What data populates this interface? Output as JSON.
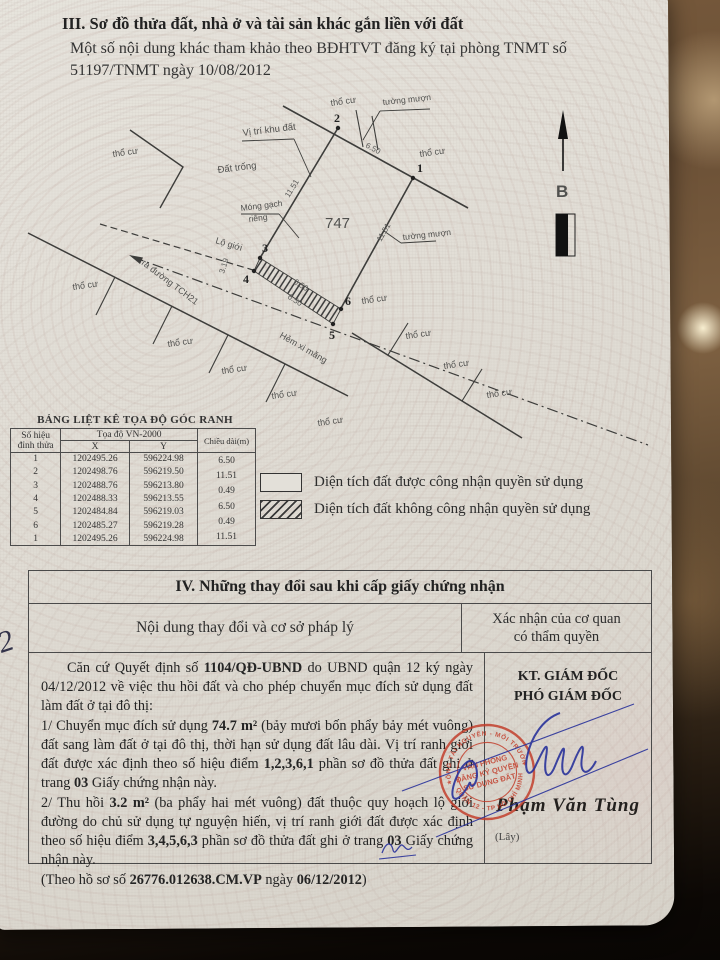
{
  "header": {
    "section3_title": "III. Sơ đồ thửa đất, nhà ở và tài sản khác gắn liền với đất",
    "note_line1": "Một số nội dung khác tham khảo theo BĐHTVT đăng ký tại phòng TNMT số",
    "note_line2": "51197/TNMT ngày 10/08/2012"
  },
  "map": {
    "parcel_number": "747",
    "north_label": "B",
    "labels": {
      "tho_cu": "thổ cư",
      "tuong_muon": "tường mượn",
      "vi_tri_khu_dat": "Vị trí khu đất",
      "dat_trong": "Đất trống",
      "mong_gach_1": "Móng gạch",
      "mong_gach_2": "riêng",
      "lo_gioi": "Lộ giới",
      "ra_duong": "ra đường TCH21",
      "hem_xi_mang": "Hẻm xi măng"
    },
    "points": {
      "p1": "1",
      "p2": "2",
      "p3": "3",
      "p4": "4",
      "p5": "5",
      "p6": "6"
    },
    "dims": {
      "d650": "6.50",
      "d1151": "11.51",
      "d319": "3.19"
    }
  },
  "coord_table": {
    "title": "BẢNG LIỆT KÊ TỌA ĐỘ GÓC RANH",
    "header": {
      "point": "Số hiệu",
      "point2": "đỉnh thửa",
      "coords": "Tọa độ VN-2000",
      "x": "X",
      "y": "Y",
      "length": "Chiều dài(m)"
    },
    "rows": [
      [
        "1",
        "1202495.26",
        "596224.98"
      ],
      [
        "2",
        "1202498.76",
        "596219.50"
      ],
      [
        "3",
        "1202488.76",
        "596213.80"
      ],
      [
        "4",
        "1202488.33",
        "596213.55"
      ],
      [
        "5",
        "1202484.84",
        "596219.03"
      ],
      [
        "6",
        "1202485.27",
        "596219.28"
      ],
      [
        "1",
        "1202495.26",
        "596224.98"
      ]
    ],
    "lengths": [
      "6.50",
      "11.51",
      "0.49",
      "6.50",
      "0.49",
      "11.51"
    ]
  },
  "legend": {
    "items": [
      {
        "style": "plain",
        "label": "Diện tích đất được công nhận quyền sử dụng"
      },
      {
        "style": "hatched",
        "label": "Diện tích đất không công nhận quyền sử dụng"
      }
    ]
  },
  "section4": {
    "title": "IV. Những thay đổi sau khi cấp giấy chứng nhận",
    "col_left": "Nội dung thay đổi và cơ sở pháp lý",
    "col_right_1": "Xác nhận của cơ quan",
    "col_right_2": "có thẩm quyền",
    "paragraphs": [
      [
        {
          "t": "Căn cứ Quyết định số "
        },
        {
          "t": "1104/QĐ-UBND",
          "b": true
        },
        {
          "t": " do UBND quận 12 ký ngày 04/12/2012 về việc thu hồi đất và cho phép chuyển mục đích sử dụng đất làm đất ở tại đô thị:"
        }
      ],
      [
        {
          "t": "1/ Chuyển mục đích sử dụng "
        },
        {
          "t": "74.7 m²",
          "b": true
        },
        {
          "t": " (bảy mươi bốn phẩy bảy mét vuông) đất sang làm đất ở tại đô thị, thời hạn sử dụng đất lâu dài. Vị trí ranh giới đất được xác định theo số hiệu điểm "
        },
        {
          "t": "1,2,3,6,1",
          "b": true
        },
        {
          "t": " phần sơ đồ thửa đất ghi ở trang "
        },
        {
          "t": "03",
          "b": true
        },
        {
          "t": " Giấy chứng nhận này."
        }
      ],
      [
        {
          "t": "2/ Thu hồi "
        },
        {
          "t": "3.2 m²",
          "b": true
        },
        {
          "t": " (ba phẩy hai mét vuông) đất thuộc quy hoạch lộ giới đường do chủ sử dụng tự nguyện hiến, vị trí ranh giới đất được xác định theo số hiệu điểm "
        },
        {
          "t": "3,4,5,6,3",
          "b": true
        },
        {
          "t": " phần sơ đồ thửa đất ghi ở trang "
        },
        {
          "t": "03",
          "b": true
        },
        {
          "t": " Giấy chứng nhận này."
        }
      ],
      [
        {
          "t": "(Theo hồ sơ số "
        },
        {
          "t": "26776.012638.CM.VP",
          "b": true
        },
        {
          "t": " ngày "
        },
        {
          "t": "06/12/2012",
          "b": true
        },
        {
          "t": ")"
        }
      ]
    ],
    "approval": {
      "kt": "KT. GIÁM ĐỐC",
      "pho": "PHÓ GIÁM ĐỐC",
      "signer_name": "Phạm Văn Tùng",
      "note": "(Lây)"
    },
    "stamp": {
      "ring_top": "PHÒNG TÀI NGUYÊN - MÔI TRƯỜNG",
      "ring_bottom": "QUẬN 12 - TP HỒ CHÍ MINH",
      "center_1": "VĂN PHÒNG",
      "center_2": "ĐĂNG KÝ QUYỀN",
      "center_3": "SỬ DỤNG ĐẤT",
      "star": "★"
    }
  },
  "annotations": {
    "margin_mark": "2"
  }
}
